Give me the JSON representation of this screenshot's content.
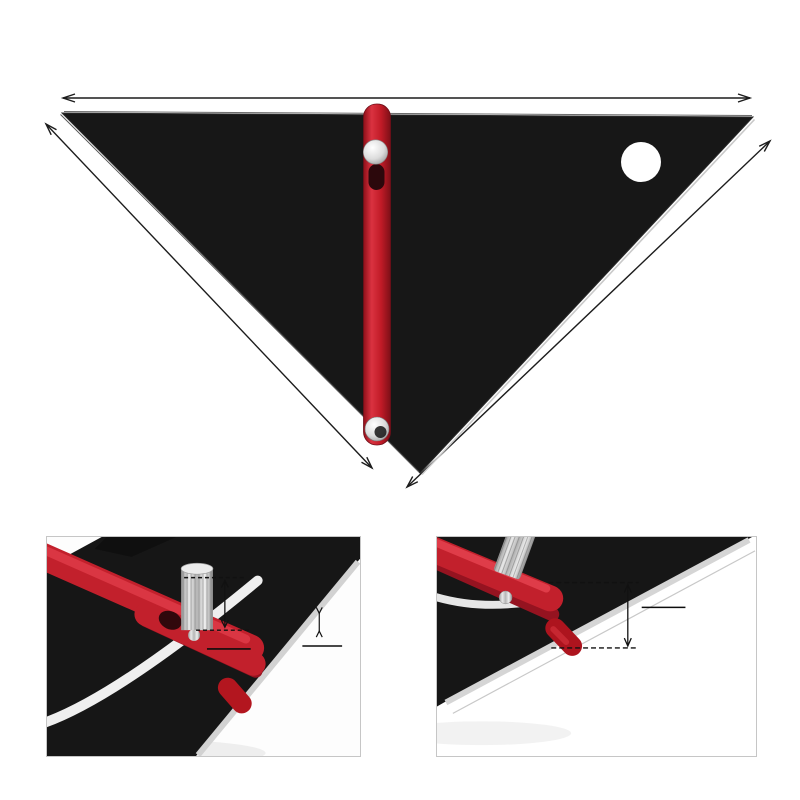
{
  "page": {
    "bg": "#ffffff",
    "body": "#171717",
    "red": "#c2202c",
    "red_light": "#e04350",
    "silver": "#d6d6d6",
    "marking": "#e4e4e4"
  },
  "dimensions": {
    "top": "268mm/10.55in",
    "left": "191mm/7.51in",
    "right": "191mm/7.51in"
  },
  "tool": {
    "arm_text": "↑ USE TOP EDGE FOR SETTING ↑",
    "labels": {
      "comjack": "COM/JACK",
      "plumb": "PLUMB",
      "cuts": "CUTS",
      "hipval": "HIP/VAL",
      "degrees": "DEGREES",
      "left_edge": "MARK PLUMB CUTS THIS EDGE",
      "right_edge": "MARK SEAT CUTS ALONG THIS EDGE"
    },
    "scales": {
      "comjack_arc": [
        "30",
        "24",
        "18",
        "15",
        "10",
        "8",
        "7",
        "6",
        "5",
        "4",
        "3",
        "2",
        "1",
        "0"
      ],
      "hipval_arc": [
        "30",
        "24",
        "18",
        "15",
        "12",
        "10",
        "8",
        "7",
        "6",
        "5",
        "4",
        "3",
        "2",
        "1",
        "0"
      ],
      "degree_arc": [
        "70°",
        "60°",
        "50°",
        "40°",
        "30°",
        "20°",
        "10°"
      ],
      "top_edge": [
        "1",
        "2",
        "3",
        "4",
        "5",
        "6",
        "7",
        "8",
        "9"
      ],
      "left_edge": [
        "5",
        "4",
        "3",
        "2",
        "1"
      ],
      "right_edge": [
        "6",
        "5",
        "4",
        "3",
        "2",
        "1"
      ],
      "seat_inner": [
        "4",
        "3",
        "2",
        "1"
      ]
    },
    "rafter_table_rows": [
      "17 19 23 26 31 37",
      "255 248 242 236",
      "104 98 95 92 90",
      "13 14 16 18 21 24",
      "339 331 324 318",
      "45 52 61 72 85",
      "208 204 200 197"
    ]
  },
  "inset_left": {
    "arm_text": "OR SETTING ↑",
    "dim1": {
      "value": "15mm",
      "sub": "0.59in"
    },
    "dim2": {
      "value": "5mm",
      "sub": "0.19in"
    },
    "deg30": "30°",
    "deg40": "40°",
    "deg60": "60°",
    "deg70": "70°",
    "frags": [
      "HIP/VAL",
      "TS",
      "UMB",
      "JACK"
    ],
    "col_numbers": [
      "30",
      "24",
      "8"
    ],
    "arcB_numbers": [
      "10",
      "12",
      "15"
    ],
    "arcA_numbers": [
      "6",
      "7",
      "8",
      "10",
      "12",
      "15"
    ]
  },
  "inset_right": {
    "dim": {
      "value": "20mm",
      "sub": "0.78in"
    },
    "numbers": [
      "15",
      "12",
      "10",
      "8",
      "8"
    ]
  }
}
